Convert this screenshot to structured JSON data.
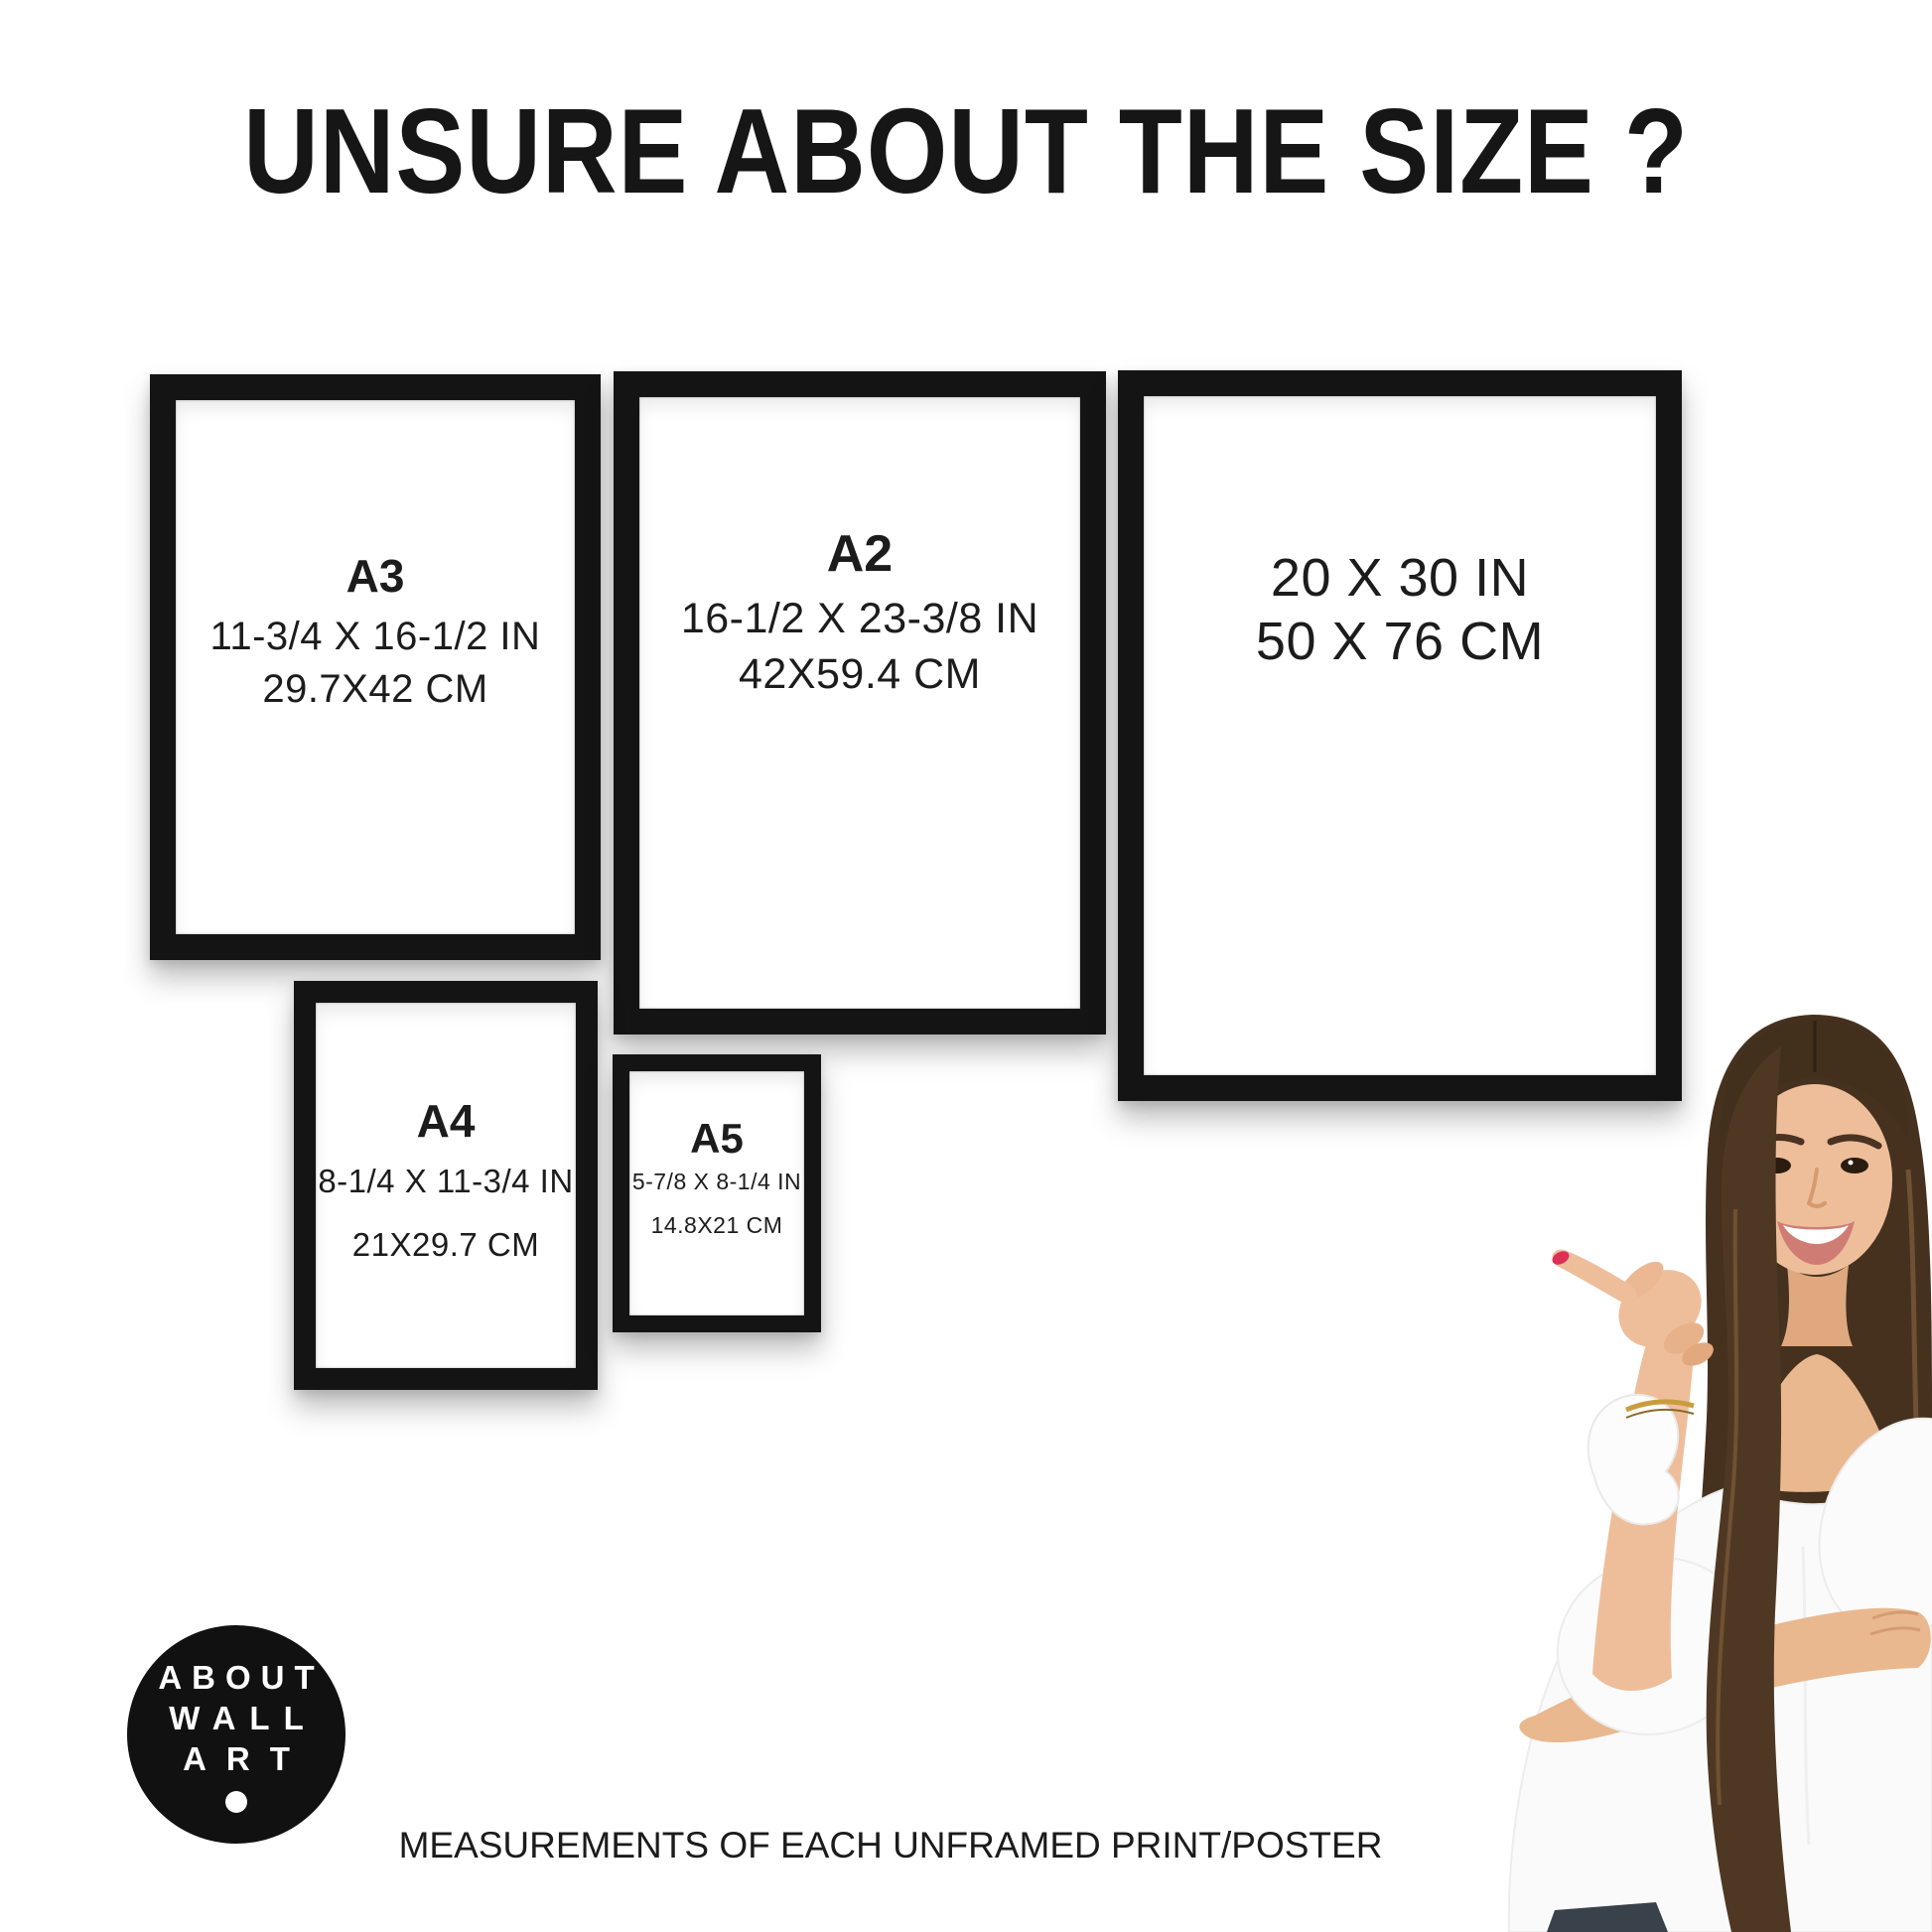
{
  "page": {
    "title": "UNSURE ABOUT THE SIZE ?",
    "footer": "MEASUREMENTS OF EACH UNFRAMED PRINT/POSTER"
  },
  "frames": [
    {
      "name": "A3 frame",
      "label": "A3",
      "inches": "11-3/4 X 16-1/2 IN",
      "cm": "29.7X42 CM"
    },
    {
      "name": "A2 frame",
      "label": "A2",
      "inches": "16-1/2 X 23-3/8 IN",
      "cm": "42X59.4 CM"
    },
    {
      "name": "20x30 frame",
      "label": "",
      "inches": "20 X 30 IN",
      "cm": "50 X 76 CM"
    },
    {
      "name": "A4 frame",
      "label": "A4",
      "inches": "8-1/4 X 11-3/4 IN",
      "cm": "21X29.7 CM"
    },
    {
      "name": "A5 frame",
      "label": "A5",
      "inches": "5-7/8 X 8-1/4 IN",
      "cm": "14.8X21 CM"
    }
  ],
  "logo": {
    "lines": [
      "ABOUT",
      "WALL",
      "ART"
    ],
    "dot_icon": "logo-dot"
  },
  "figure": {
    "icon": "woman-pointing-photo"
  },
  "colors": {
    "background": "#ffffff",
    "frame_black": "#141414",
    "text": "#1a1a1a",
    "logo_background": "#111111",
    "logo_text": "#ffffff",
    "hair": "#46311f",
    "skin": "#eebe9b",
    "blouse": "#fafafa",
    "nail_polish": "#de2f57",
    "jeans": "#39414a"
  }
}
